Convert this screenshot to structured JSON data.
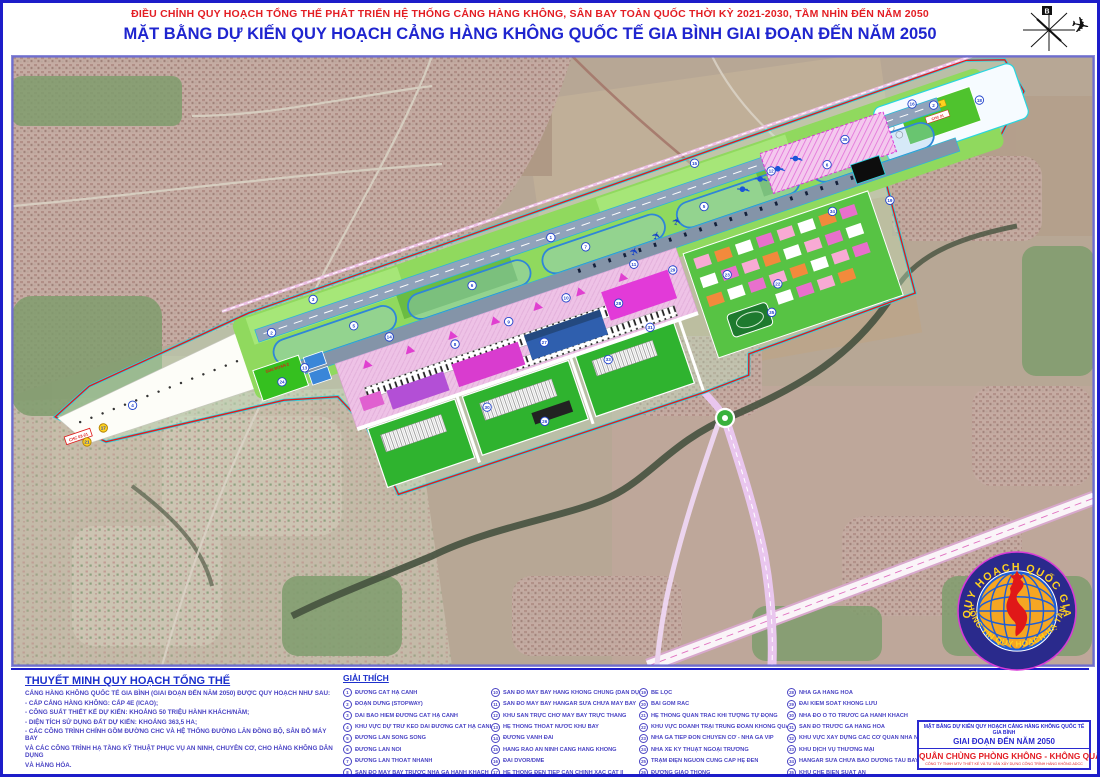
{
  "header": {
    "line1": "ĐIỀU CHỈNH QUY HOẠCH TỔNG THỂ PHÁT TRIỂN HỆ THỐNG CẢNG HÀNG KHÔNG, SÂN BAY TOÀN QUỐC THỜI KỲ 2021-2030, TẦM NHÌN ĐẾN NĂM 2050",
    "line2": "MẶT BẰNG DỰ KIẾN QUY HOẠCH CẢNG HÀNG KHÔNG QUỐC TẾ GIA BÌNH GIAI ĐOẠN ĐẾN NĂM 2050",
    "north_label": "B"
  },
  "notes": {
    "title": "THUYẾT MINH QUY HOẠCH TỔNG THỂ",
    "lines": [
      "CẢNG HÀNG KHÔNG QUỐC TẾ GIA BÌNH (GIAI ĐOẠN ĐẾN NĂM 2050) ĐƯỢC QUY HOẠCH NHƯ SAU:",
      "- CẤP CẢNG HÀNG KHÔNG: CẤP 4E (ICAO);",
      "- CÔNG SUẤT THIẾT KẾ DỰ KIẾN: KHOẢNG 50 TRIỆU HÀNH KHÁCH/NĂM;",
      "- DIỆN TÍCH SỬ DỤNG ĐẤT DỰ KIẾN: KHOẢNG 363,5 HA;",
      "- CÁC CÔNG TRÌNH CHÍNH GỒM ĐƯỜNG CHC VÀ HỆ THỐNG ĐƯỜNG LĂN ĐỒNG BỘ, SÂN ĐỖ MÁY BAY",
      "VÀ CÁC CÔNG TRÌNH HẠ TẦNG KỸ THUẬT PHỤC VỤ AN NINH, CHUYÊN CƠ, CHO HÀNG KHÔNG DÂN DỤNG",
      "VÀ HÀNG HÓA."
    ]
  },
  "legend": {
    "title": "GIẢI THÍCH",
    "columns": [
      [
        {
          "n": "1",
          "label": "ĐƯỜNG CẤT HẠ CÁNH"
        },
        {
          "n": "2",
          "label": "ĐOẠN DỪNG (STOPWAY)"
        },
        {
          "n": "3",
          "label": "DẢI BẢO HIỂM ĐƯỜNG CẤT HẠ CÁNH"
        },
        {
          "n": "4",
          "label": "KHU VỰC DỰ TRỮ KÉO DÀI ĐƯỜNG CẤT HẠ CÁNH"
        },
        {
          "n": "5",
          "label": "ĐƯỜNG LĂN SONG SONG"
        },
        {
          "n": "6",
          "label": "ĐƯỜNG LĂN NỐI"
        },
        {
          "n": "7",
          "label": "ĐƯỜNG LĂN THOÁT NHANH"
        },
        {
          "n": "8",
          "label": "SÂN ĐỖ MÁY BAY TRƯỚC NHÀ GA HÀNH KHÁCH"
        },
        {
          "n": "9",
          "label": "SÂN ĐỖ MÁY BAY CHUYÊN CƠ"
        }
      ],
      [
        {
          "n": "10",
          "label": "SÂN ĐỖ MÁY BAY HÀNG KHÔNG CHUNG (DÂN DỤNG)"
        },
        {
          "n": "11",
          "label": "SÂN ĐỖ MÁY BAY HANGAR SỬA CHỮA MÁY BAY"
        },
        {
          "n": "12",
          "label": "KHU SÂN TRỰC CHỜ MÁY BAY TRỰC THĂNG"
        },
        {
          "n": "13",
          "label": "HỆ THỐNG THOÁT NƯỚC KHU BAY"
        },
        {
          "n": "14",
          "label": "ĐƯỜNG VÀNH ĐAI"
        },
        {
          "n": "15",
          "label": "HÀNG RÀO AN NINH CẢNG HÀNG KHÔNG"
        },
        {
          "n": "16",
          "label": "ĐÀI DVOR/DME"
        },
        {
          "n": "17",
          "label": "HỆ THỐNG ĐÈN TIẾP CẬN CHÍNH XÁC CAT II"
        },
        {
          "n": "18",
          "label": "HỆ THỐNG ĐÈN TIẾP CẬN GIẢN ĐƠN"
        }
      ],
      [
        {
          "n": "19",
          "label": "BỂ LỌC"
        },
        {
          "n": "20",
          "label": "BÃI GOM RÁC"
        },
        {
          "n": "21",
          "label": "HỆ THỐNG QUAN TRẮC KHÍ TƯỢNG TỰ ĐỘNG"
        },
        {
          "n": "22",
          "label": "KHU VỰC DOANH TRẠI TRUNG ĐOÀN KHÔNG QUÂN"
        },
        {
          "n": "23",
          "label": "NHÀ GA TIẾP ĐÓN CHUYÊN CƠ - NHÀ GA VIP"
        },
        {
          "n": "24",
          "label": "NHÀ XE KỸ THUẬT NGOẠI TRƯỜNG"
        },
        {
          "n": "25",
          "label": "TRẠM ĐIỆN NGUỒN CUNG CẤP HỆ ĐÈN"
        },
        {
          "n": "26",
          "label": "ĐƯỜNG GIAO THÔNG"
        },
        {
          "n": "27",
          "label": "NHÀ GA HÀNH KHÁCH"
        }
      ],
      [
        {
          "n": "28",
          "label": "NHÀ GA HÀNG HÓA"
        },
        {
          "n": "29",
          "label": "ĐÀI KIỂM SOÁT KHÔNG LƯU"
        },
        {
          "n": "30",
          "label": "NHÀ ĐỖ Ô TÔ TRƯỚC GA HÀNH KHÁCH"
        },
        {
          "n": "31",
          "label": "SÂN ĐỖ TRƯỚC GA HÀNG HÓA"
        },
        {
          "n": "32",
          "label": "KHU VỰC XÂY DỰNG CÁC CƠ QUAN NHÀ NƯỚC TẠI CHK"
        },
        {
          "n": "33",
          "label": "KHU DỊCH VỤ THƯƠNG MẠI"
        },
        {
          "n": "34",
          "label": "HANGAR SỬA CHỮA BẢO DƯỠNG TÀU BAY"
        },
        {
          "n": "35",
          "label": "KHU CHẾ BIẾN SUẤT ĂN"
        },
        {
          "n": "36",
          "label": "KHU VỰC DỰ TRỮ PHÁT TRIỂN HÀNG KHÔNG DÂN DỤNG"
        }
      ]
    ]
  },
  "map": {
    "colors": {
      "boundary_red": "#e61a1a",
      "cyan_band": "#29d2e2",
      "runway_gray": "#91a3bb",
      "taxiway_blue": "#2f86d8",
      "strip_green": "#90d95e",
      "apron_pink": "#eec2e6",
      "terminal_magenta": "#d93ccf",
      "terminal_blue": "#2f5fae",
      "landside_green": "#2fb32f",
      "road_pink": "#e9c6ee"
    },
    "small_labels": {
      "sw_box": "CHC 03-21",
      "stage": "GIAI ĐOẠN 2",
      "ne_yellow": "ĐÀI VOR",
      "ne_red": "CHC 21"
    },
    "markers": [
      {
        "n": "4",
        "x": 95,
        "y": 2
      },
      {
        "n": "17",
        "x": 60,
        "y": 14,
        "c": "y"
      },
      {
        "n": "21",
        "x": 40,
        "y": 22,
        "c": "y"
      },
      {
        "n": "2",
        "x": 250,
        "y": -22
      },
      {
        "n": "3",
        "x": 300,
        "y": -40
      },
      {
        "n": "1",
        "x": 545,
        "y": -22
      },
      {
        "n": "2",
        "x": 950,
        "y": -24
      },
      {
        "n": "5",
        "x": 330,
        "y": -2
      },
      {
        "n": "6",
        "x": 455,
        "y": -2
      },
      {
        "n": "7",
        "x": 575,
        "y": -2
      },
      {
        "n": "5",
        "x": 700,
        "y": -2
      },
      {
        "n": "6",
        "x": 830,
        "y": -2
      },
      {
        "n": "13",
        "x": 270,
        "y": 22
      },
      {
        "n": "14",
        "x": 360,
        "y": 20
      },
      {
        "n": "8",
        "x": 420,
        "y": 48
      },
      {
        "n": "9",
        "x": 478,
        "y": 44
      },
      {
        "n": "10",
        "x": 540,
        "y": 40
      },
      {
        "n": "11",
        "x": 615,
        "y": 30
      },
      {
        "n": "12",
        "x": 775,
        "y": -14
      },
      {
        "n": "15",
        "x": 705,
        "y": -46
      },
      {
        "n": "16",
        "x": 930,
        "y": -32
      },
      {
        "n": "18",
        "x": 995,
        "y": -14
      },
      {
        "n": "27",
        "x": 505,
        "y": 75
      },
      {
        "n": "28",
        "x": 588,
        "y": 62
      },
      {
        "n": "29",
        "x": 650,
        "y": 48
      },
      {
        "n": "30",
        "x": 430,
        "y": 118
      },
      {
        "n": "33",
        "x": 560,
        "y": 112
      },
      {
        "n": "26",
        "x": 480,
        "y": 150
      },
      {
        "n": "22",
        "x": 745,
        "y": 95
      },
      {
        "n": "23",
        "x": 700,
        "y": 70
      },
      {
        "n": "34",
        "x": 820,
        "y": 44
      },
      {
        "n": "35",
        "x": 730,
        "y": 120
      },
      {
        "n": "31",
        "x": 610,
        "y": 95
      },
      {
        "n": "24",
        "x": 244,
        "y": 28
      },
      {
        "n": "36",
        "x": 855,
        "y": -20
      },
      {
        "n": "19",
        "x": 878,
        "y": 52
      }
    ]
  },
  "stamp": {
    "top": "QUY HOẠCH QUỐC GIA",
    "bottom": "THÔNG TIN QUY HOẠCH-HẠ TẦNG"
  },
  "titleblock": {
    "line1": "MẶT BẰNG DỰ KIẾN QUY HOẠCH CẢNG HÀNG KHÔNG QUỐC TẾ GIA BÌNH",
    "line2": "GIAI ĐOẠN ĐẾN NĂM 2050",
    "line3": "QUÂN CHỦNG PHÒNG KHÔNG - KHÔNG QUÂN",
    "line4": "CÔNG TY TNHH MTV THIẾT KẾ VÀ TƯ VẤN XÂY DỰNG CÔNG TRÌNH HÀNG KHÔNG ADCC"
  }
}
